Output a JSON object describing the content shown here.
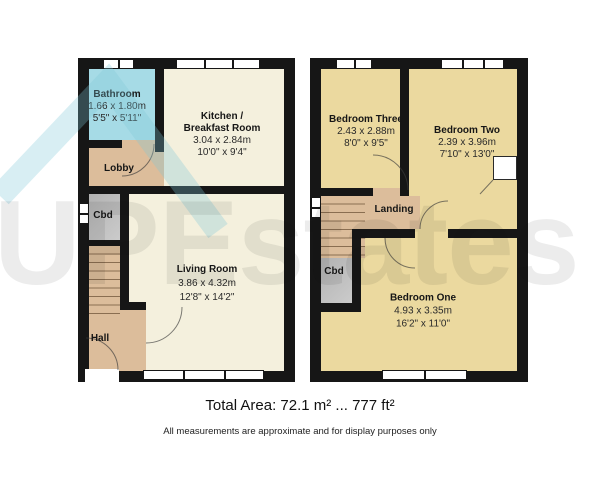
{
  "watermark": {
    "text": "UPEstates",
    "logo": "house-roof-icon",
    "logo_color": "#7ec8d8",
    "text_color_overlay": "rgba(10,10,10,0.08)"
  },
  "colors": {
    "wall": "#161616",
    "bathroom_fill": "#a6dbe6",
    "kitchen_living_fill": "#f4f0dd",
    "hall_lobby_landing_fill": "#dcbd9b",
    "bedroom_fill": "#ebd99f",
    "cupboard_fill": "#c2c2c2"
  },
  "floors": {
    "ground": {
      "rooms": {
        "bathroom": {
          "name": "Bathroom",
          "metric": "1.66 x 1.80m",
          "imperial": "5'5\" x 5'11\""
        },
        "kitchen": {
          "name_line1": "Kitchen /",
          "name_line2": "Breakfast Room",
          "metric": "3.04 x 2.84m",
          "imperial": "10'0\" x 9'4\""
        },
        "lobby": {
          "name": "Lobby"
        },
        "cbd": {
          "name": "Cbd"
        },
        "living": {
          "name": "Living Room",
          "metric": "3.86 x 4.32m",
          "imperial": "12'8\" x 14'2\""
        },
        "hall": {
          "name": "Hall"
        }
      }
    },
    "first": {
      "rooms": {
        "bedroom3": {
          "name": "Bedroom Three",
          "metric": "2.43 x 2.88m",
          "imperial": "8'0\" x 9'5\""
        },
        "bedroom2": {
          "name": "Bedroom Two",
          "metric": "2.39 x 3.96m",
          "imperial": "7'10\" x 13'0\""
        },
        "landing": {
          "name": "Landing"
        },
        "cbd": {
          "name": "Cbd"
        },
        "bedroom1": {
          "name": "Bedroom One",
          "metric": "4.93 x 3.35m",
          "imperial": "16'2\" x 11'0\""
        }
      }
    }
  },
  "footer": {
    "total_area": "Total Area: 72.1 m² ... 777 ft²",
    "disclaimer": "All measurements are approximate and for display purposes only"
  }
}
